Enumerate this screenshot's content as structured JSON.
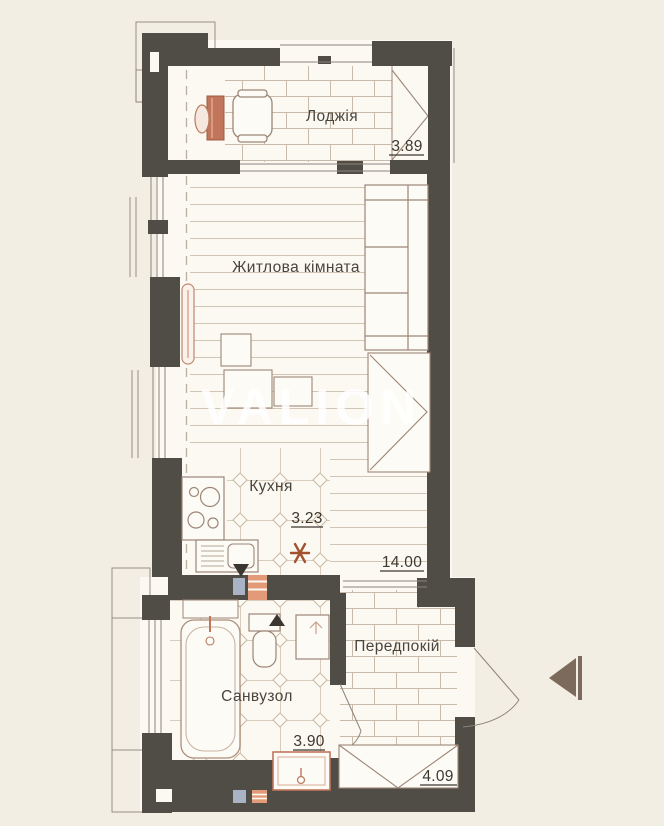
{
  "watermark": {
    "text": "VALION"
  },
  "rooms": {
    "loggia": {
      "name": "Лоджія",
      "area": "3.89"
    },
    "living_room": {
      "name": "Житлова кімната",
      "area": "14.00"
    },
    "kitchen": {
      "name": "Кухня",
      "area": "3.23"
    },
    "bathroom": {
      "name": "Санвузол",
      "area": "3.90"
    },
    "hallway": {
      "name": "Передпокій",
      "area": "4.09"
    }
  },
  "colors": {
    "background": "#f3eee4",
    "wall": "#504c46",
    "floor": "#fcf9f3",
    "furniture_line": "#9c8676",
    "accent_red": "#c1755b",
    "riser_blue": "#a9b3c6",
    "riser_orange": "#e29a78",
    "arrow": "#7c6a5c"
  }
}
